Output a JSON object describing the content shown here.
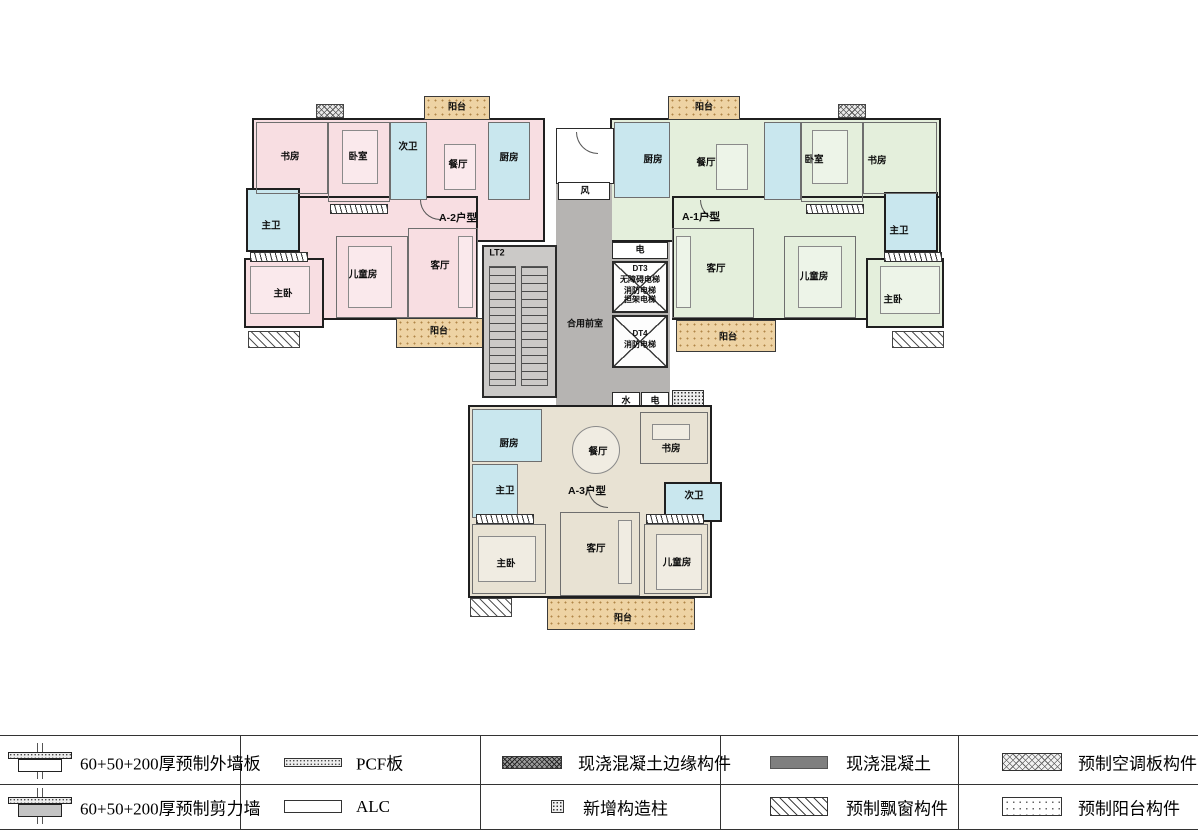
{
  "plan": {
    "a2": {
      "type_label": "A-2户型",
      "study": "书房",
      "bedroom": "卧室",
      "bath2": "次卫",
      "dining": "餐厅",
      "kitchen": "厨房",
      "mbath": "主卫",
      "mbed": "主卧",
      "kids": "儿童房",
      "living": "客厅",
      "balcony_top": "阳台",
      "balcony_bottom": "阳台"
    },
    "a1": {
      "type_label": "A-1户型",
      "kitchen": "厨房",
      "dining": "餐厅",
      "bedroom": "卧室",
      "study": "书房",
      "mbath": "主卫",
      "mbed": "主卧",
      "kids": "儿童房",
      "living": "客厅",
      "balcony_top": "阳台",
      "balcony_bottom": "阳台"
    },
    "a3": {
      "type_label": "A-3户型",
      "kitchen": "厨房",
      "dining": "餐厅",
      "study": "书房",
      "mbath": "主卫",
      "bath2": "次卫",
      "mbed": "主卧",
      "living": "客厅",
      "kids": "儿童房",
      "balcony": "阳台",
      "water": "水",
      "elec": "电"
    },
    "core": {
      "stair": "LT2",
      "vent": "风",
      "elec_room": "电",
      "lobby": "合用前室",
      "dt3": {
        "id": "DT3",
        "l1": "无障碍电梯",
        "l2": "消防电梯",
        "l3": "担架电梯"
      },
      "dt4": {
        "id": "DT4",
        "l1": "消防电梯"
      }
    }
  },
  "legend": {
    "r1c1": "60+50+200厚预制外墙板",
    "r2c1": "60+50+200厚预制剪力墙",
    "r1c2": "PCF板",
    "r2c2": "ALC",
    "r1c3": "现浇混凝土边缘构件",
    "r2c3": "新增构造柱",
    "r1c4": "现浇混凝土",
    "r2c4": "预制飘窗构件",
    "r1c5": "预制空调板构件",
    "r2c5": "预制阳台构件"
  },
  "colors": {
    "unit_a2": "#f8dee2",
    "unit_a1": "#e4efdc",
    "unit_a3": "#e8e2d3",
    "wet_room": "#c9e7ee",
    "balcony": "#eed3a4",
    "core_gray": "#b6b4b2",
    "wall": "#1f1f1f"
  }
}
